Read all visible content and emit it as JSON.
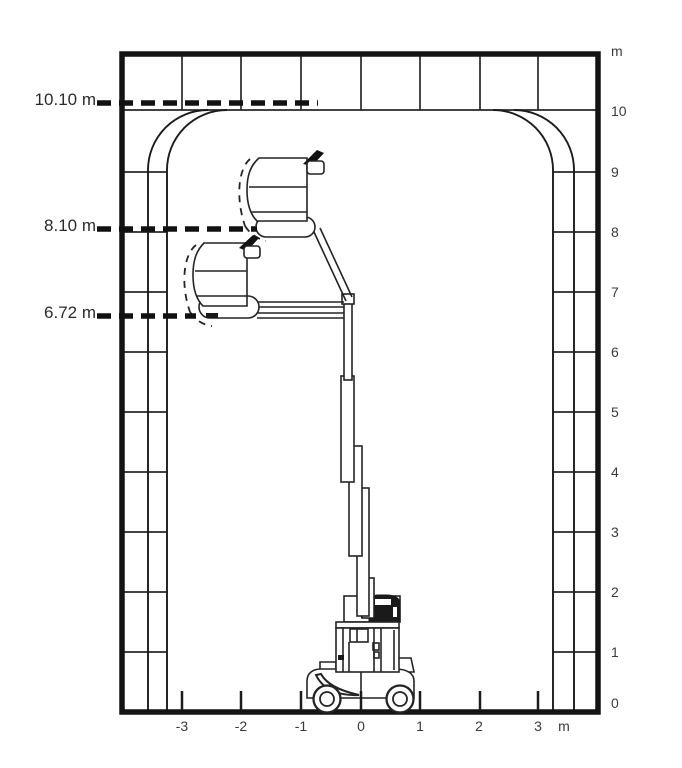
{
  "page": {
    "background_color": "#ffffff",
    "ink_color": "#1c1c1c"
  },
  "envelope_chart": {
    "type": "working-envelope-diagram",
    "machine_icon": "vertical-mast-boom-lift-side-view",
    "height_markers": [
      {
        "label": "10.10 m",
        "value_m": 10.1
      },
      {
        "label": "8.10 m",
        "value_m": 8.1
      },
      {
        "label": "6.72 m",
        "value_m": 6.72
      }
    ],
    "x_axis": {
      "unit_label": "m",
      "ticks": [
        "-3",
        "-2",
        "-1",
        "0",
        "1",
        "2",
        "3"
      ],
      "range_m": [
        -4,
        4
      ]
    },
    "y_axis": {
      "unit_label": "m",
      "ticks": [
        "10",
        "9",
        "8",
        "7",
        "6",
        "5",
        "4",
        "3",
        "2",
        "1",
        "0"
      ],
      "range_m": [
        0,
        11
      ]
    }
  }
}
